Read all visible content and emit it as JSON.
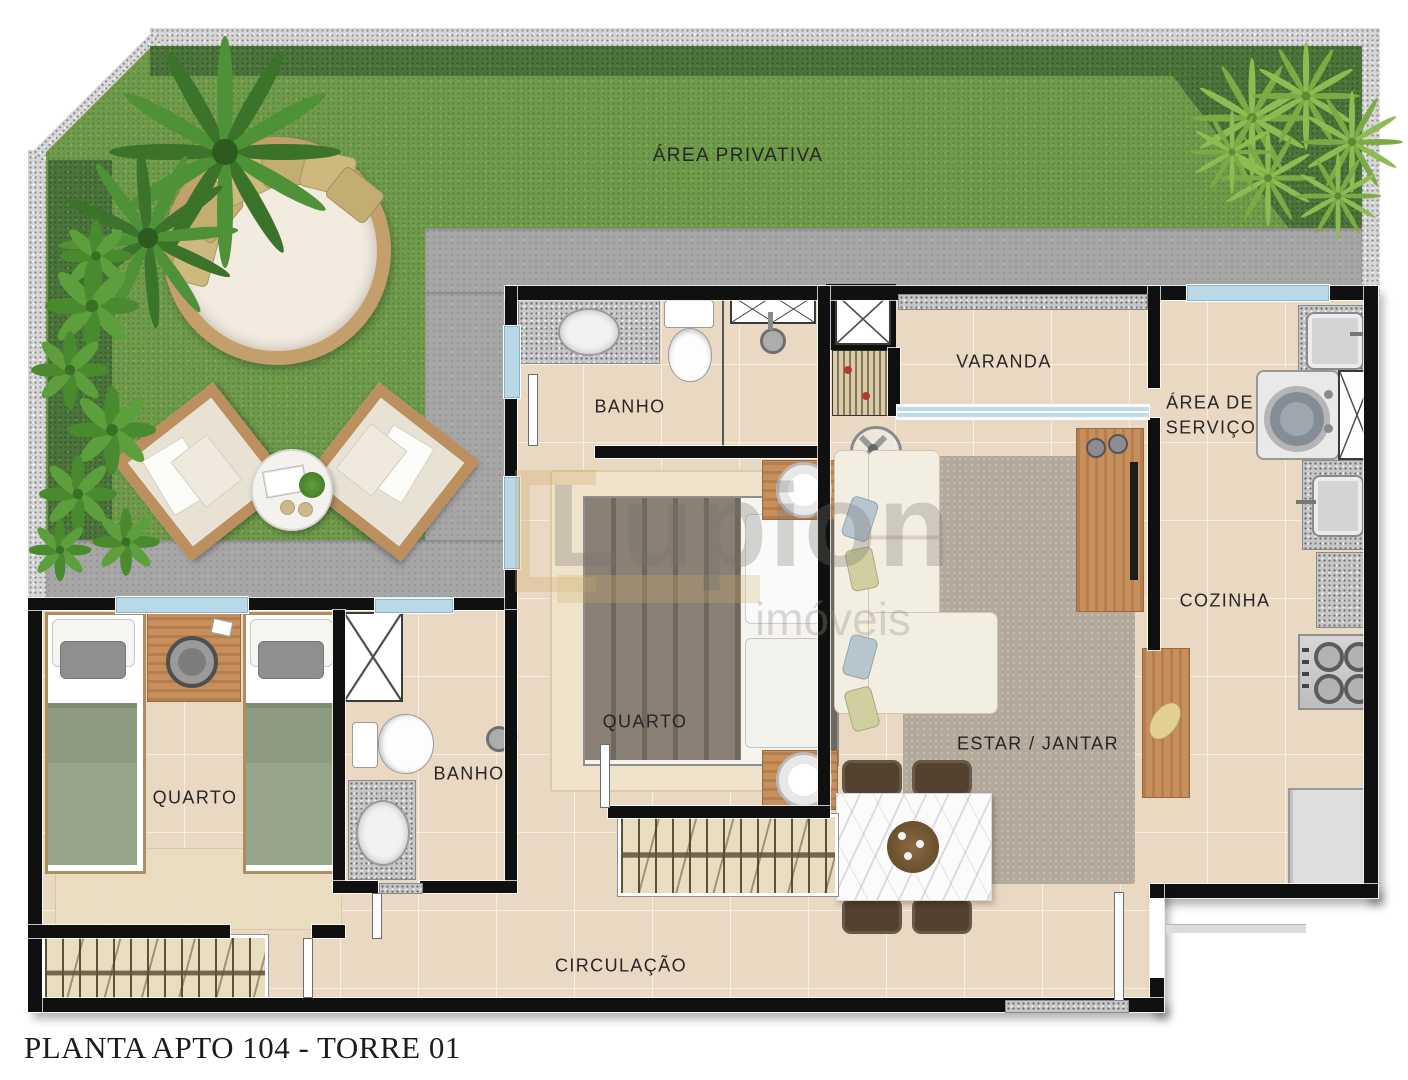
{
  "title": "PLANTA APTO 104 - TORRE 01",
  "watermark": {
    "brand": "Lupion",
    "tagline": "imóveis"
  },
  "labels": {
    "area_privativa": "ÁREA PRIVATIVA",
    "banho_suite": "BANHO",
    "varanda": "VARANDA",
    "area_servico_line1": "ÁREA DE",
    "area_servico_line2": "SERVIÇO",
    "cozinha": "COZINHA",
    "quarto_casal": "QUARTO",
    "quarto_solteiros": "QUARTO",
    "banho_social": "BANHO",
    "estar_jantar": "ESTAR / JANTAR",
    "circulacao": "CIRCULAÇÃO"
  },
  "colors": {
    "lawn": "#6f9b4b",
    "planting_bed": "#4a7439",
    "gravel": "#d6d6d6",
    "walkway": "#a6a6a6",
    "floor_tile": "#ead9c2",
    "wall": "#101010",
    "window_glass": "#b9d8e8",
    "granite": "#c6c6c6",
    "wood": "#c68f5c",
    "bed_green": "#96a58a",
    "sofa_cream": "#f3eee2",
    "rug_gray": "#b4aa9b",
    "marble": "#fbfbfb",
    "chair_brown": "#53422f",
    "label_text": "#262626"
  }
}
